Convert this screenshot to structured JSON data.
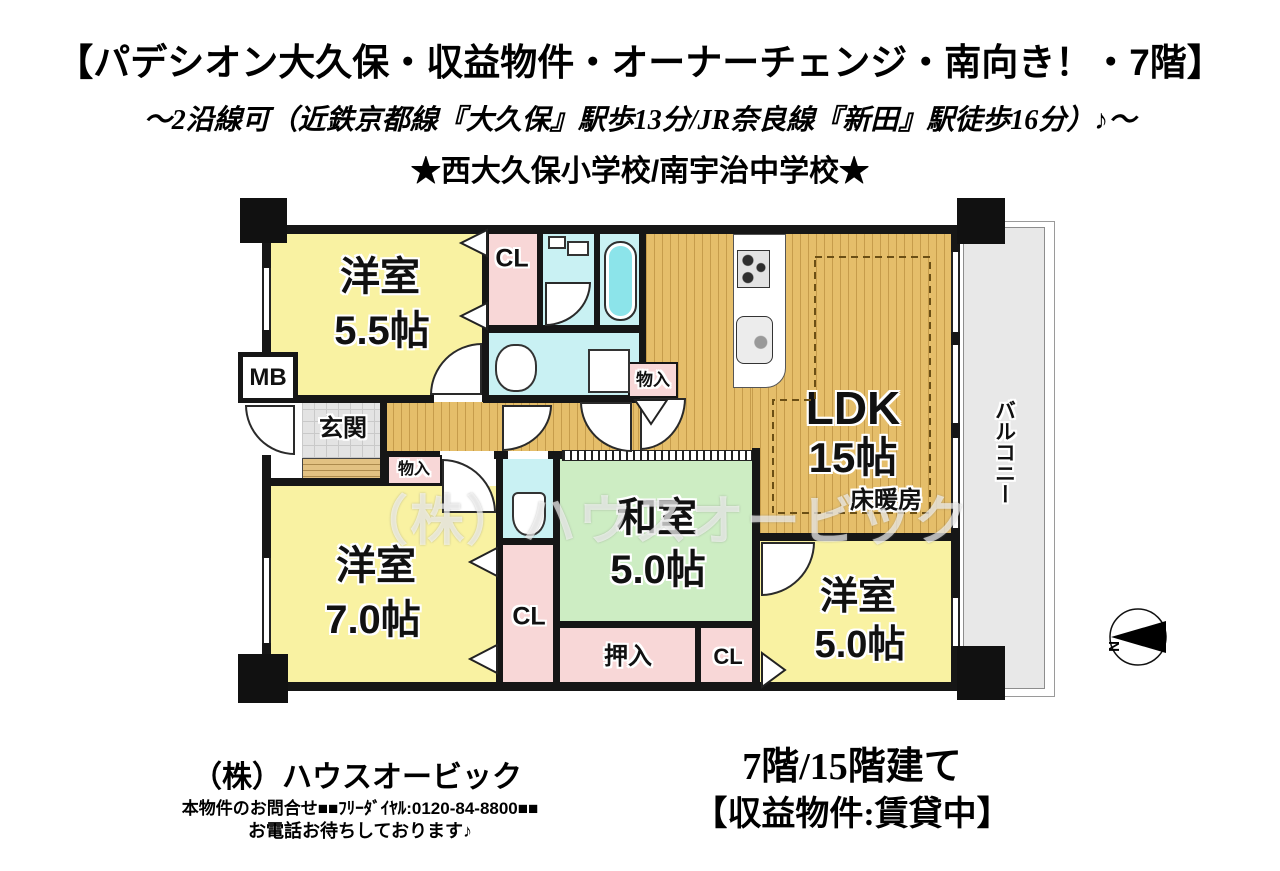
{
  "header": {
    "title": "【パデシオン大久保・収益物件・オーナーチェンジ・南向き！・7階】",
    "subtitle": "～2沿線可（近鉄京都線『大久保』駅歩13分/JR奈良線『新田』駅徒歩16分）♪～",
    "schools": "★西大久保小学校/南宇治中学校★"
  },
  "plan": {
    "rooms": {
      "yoshitsu55_name": "洋室",
      "yoshitsu55_size": "5.5帖",
      "yoshitsu70_name": "洋室",
      "yoshitsu70_size": "7.0帖",
      "yoshitsu50_name": "洋室",
      "yoshitsu50_size": "5.0帖",
      "washitsu_name": "和室",
      "washitsu_size": "5.0帖",
      "ldk_name": "LDK",
      "ldk_size": "15帖",
      "ldk_note": "床暖房",
      "genkan": "玄関",
      "balcony": "バルコニー",
      "mb": "MB",
      "cl": "CL",
      "monoiri": "物入",
      "oshiire": "押入"
    },
    "compass_label": "N",
    "watermark": "（株）ハウスオービック"
  },
  "footer": {
    "company": "（株）ハウスオービック",
    "contact": "本物件のお問合せ■■ﾌﾘｰﾀﾞｲﾔﾙ:0120-84-8800■■",
    "contact2": "お電話お待ちしております♪",
    "floor_info": "7階/15階建て",
    "status": "【収益物件:賃貸中】"
  },
  "colors": {
    "room_yellow": "#F9F2A2",
    "wood_tan": "#E5BE6A",
    "tatami_green": "#CDEDC3",
    "closet_pink": "#F8D7D7",
    "wet_cyan": "#C9F1F3",
    "tub_cyan": "#8CE4EA",
    "entry_gray": "#E3E3E3",
    "balcony_gray": "#E8E8E8",
    "wall_black": "#161616"
  }
}
